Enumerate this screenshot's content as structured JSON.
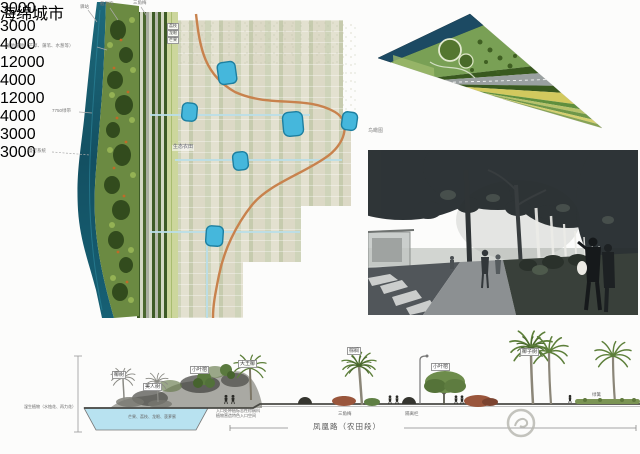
{
  "watermark": {
    "text": "海绵城市"
  },
  "plan": {
    "top_labels": [
      "驿站",
      "截洪沟",
      "三角梅"
    ],
    "left_labels": [
      "湿地植物（芒草、蒲苇、水葱等）",
      "7750绿带",
      "慢行系统"
    ],
    "orchard_labels": [
      "荔枝",
      "龙眼",
      "芒果"
    ],
    "farm_label": "生态农田",
    "colors": {
      "river": "#1d6a7c",
      "vegetation": "#6b8a42",
      "pond": "#45b7dc",
      "path": "#c8824d"
    }
  },
  "aerial": {
    "caption": "鸟瞰图"
  },
  "section": {
    "plant_boxes": [
      "椰树",
      "美人树",
      "小叶榕",
      "大王椰",
      "棕榈",
      "小叶榕",
      "椰子树"
    ],
    "wetland_note": "湿生植物（水烛花、再力花）",
    "orchard_note": "芒果、荔枝、龙眼、菠萝蜜",
    "entrance_note_line1": "入口处种植标志性棕榈科",
    "entrance_note_line2": "植物营造特色入口空间",
    "shrub_label": "三角梅",
    "barrier_label": "隔离栏",
    "hedge_label": "绿篱",
    "road_title": "凤凰路（农田段）",
    "dimensions": [
      "3000",
      "3000",
      "4000",
      "12000",
      "4000",
      "12000",
      "4000",
      "3000",
      "3000"
    ]
  }
}
